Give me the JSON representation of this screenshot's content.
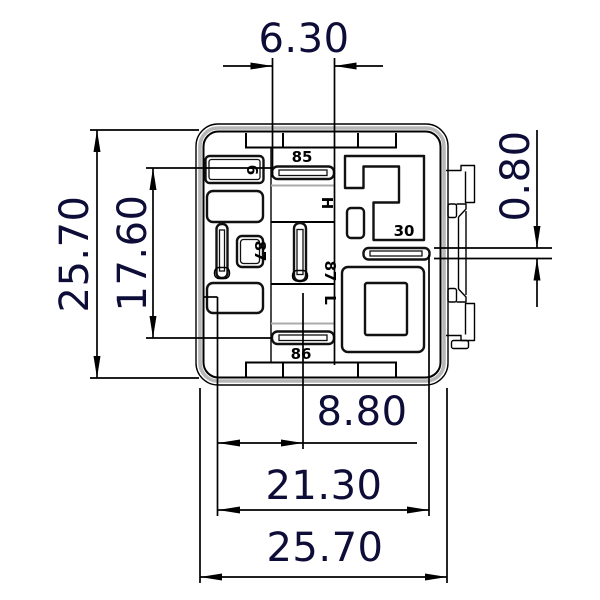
{
  "drawing": {
    "type": "technical-dimension-drawing",
    "subject": "relay-socket-footprint-bottom-view",
    "units": "mm",
    "colors": {
      "line": "#000000",
      "dim_text": "#0d0d38",
      "shade_gray": "#b7b7b7",
      "background": "#ffffff"
    }
  },
  "dims": {
    "top_slot_length": "6.30",
    "left_overall": "25.70",
    "left_pin_span": "17.60",
    "right_slot_thickness": "0.80",
    "bottom_pin_offset": "8.80",
    "bottom_inner_width": "21.30",
    "bottom_overall": "25.70"
  },
  "pins": {
    "p85": "85",
    "p86": "86",
    "p87_left": "87",
    "p87_center": "87",
    "p30": "30",
    "p6": "6",
    "ph": "H",
    "pl": "L"
  }
}
